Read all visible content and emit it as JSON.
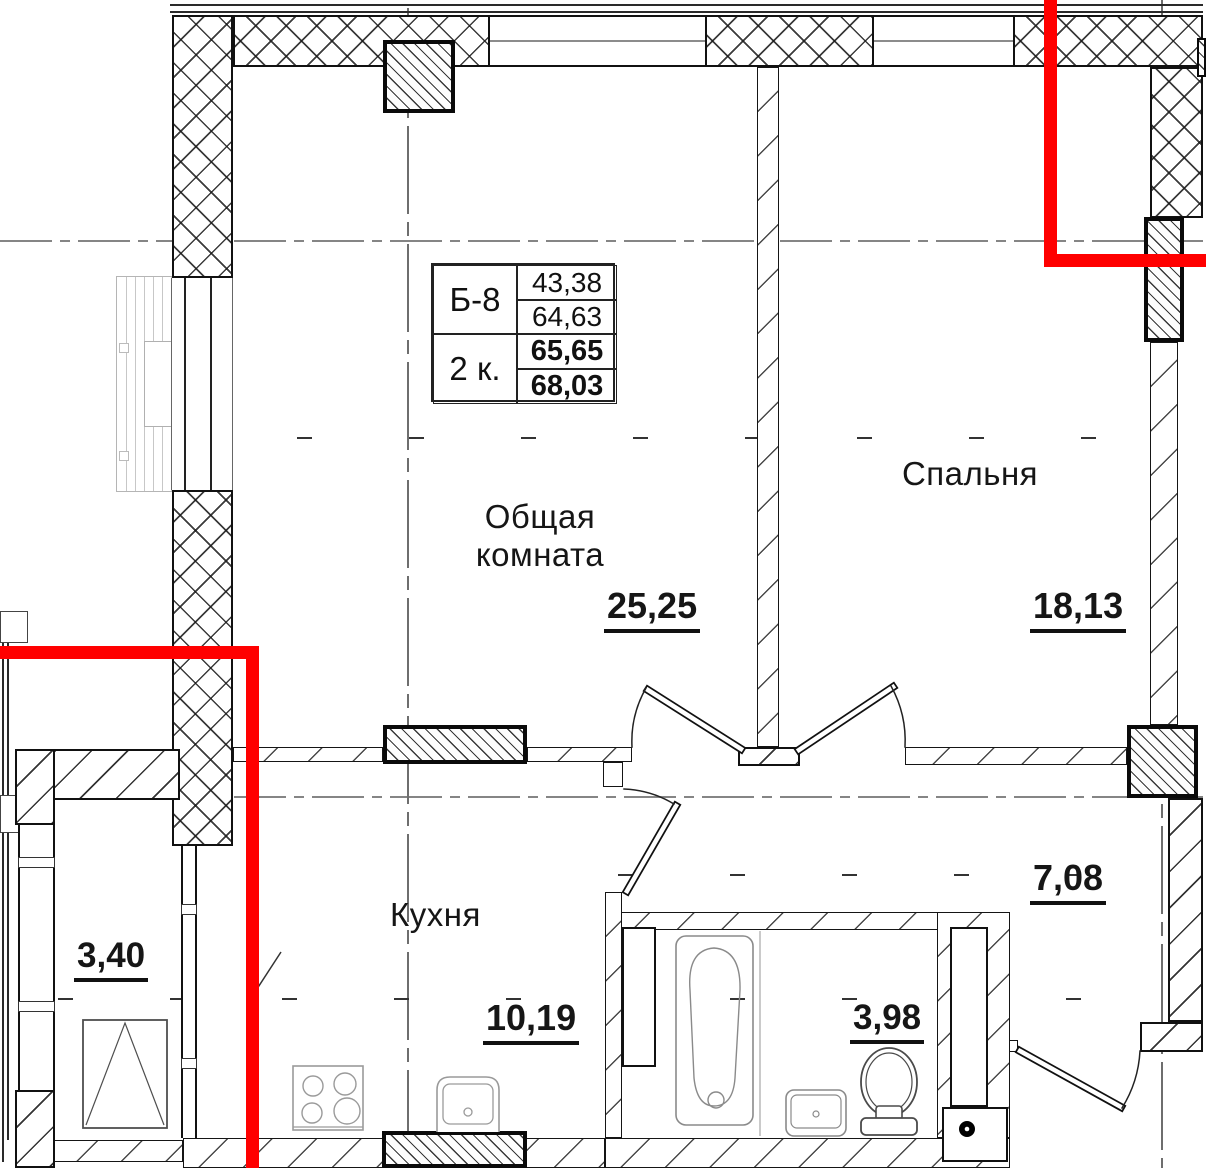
{
  "title": "План квартиры Б-8",
  "colors": {
    "accent_red": "#ff0000",
    "line": "#111111",
    "axis": "#858585"
  },
  "info_table": {
    "unit_label": "Б-8",
    "rooms_label": "2 к.",
    "values": [
      "43,38",
      "64,63",
      "65,65",
      "68,03"
    ]
  },
  "rooms": {
    "living": {
      "name_line1": "Общая",
      "name_line2": "комната",
      "area": "25,25"
    },
    "bedroom": {
      "name": "Спальня",
      "area": "18,13"
    },
    "kitchen": {
      "name": "Кухня",
      "area": "10,19"
    },
    "hall": {
      "area": "7,08"
    },
    "bathroom": {
      "area": "3,98"
    },
    "balcony": {
      "area": "3,40"
    }
  }
}
